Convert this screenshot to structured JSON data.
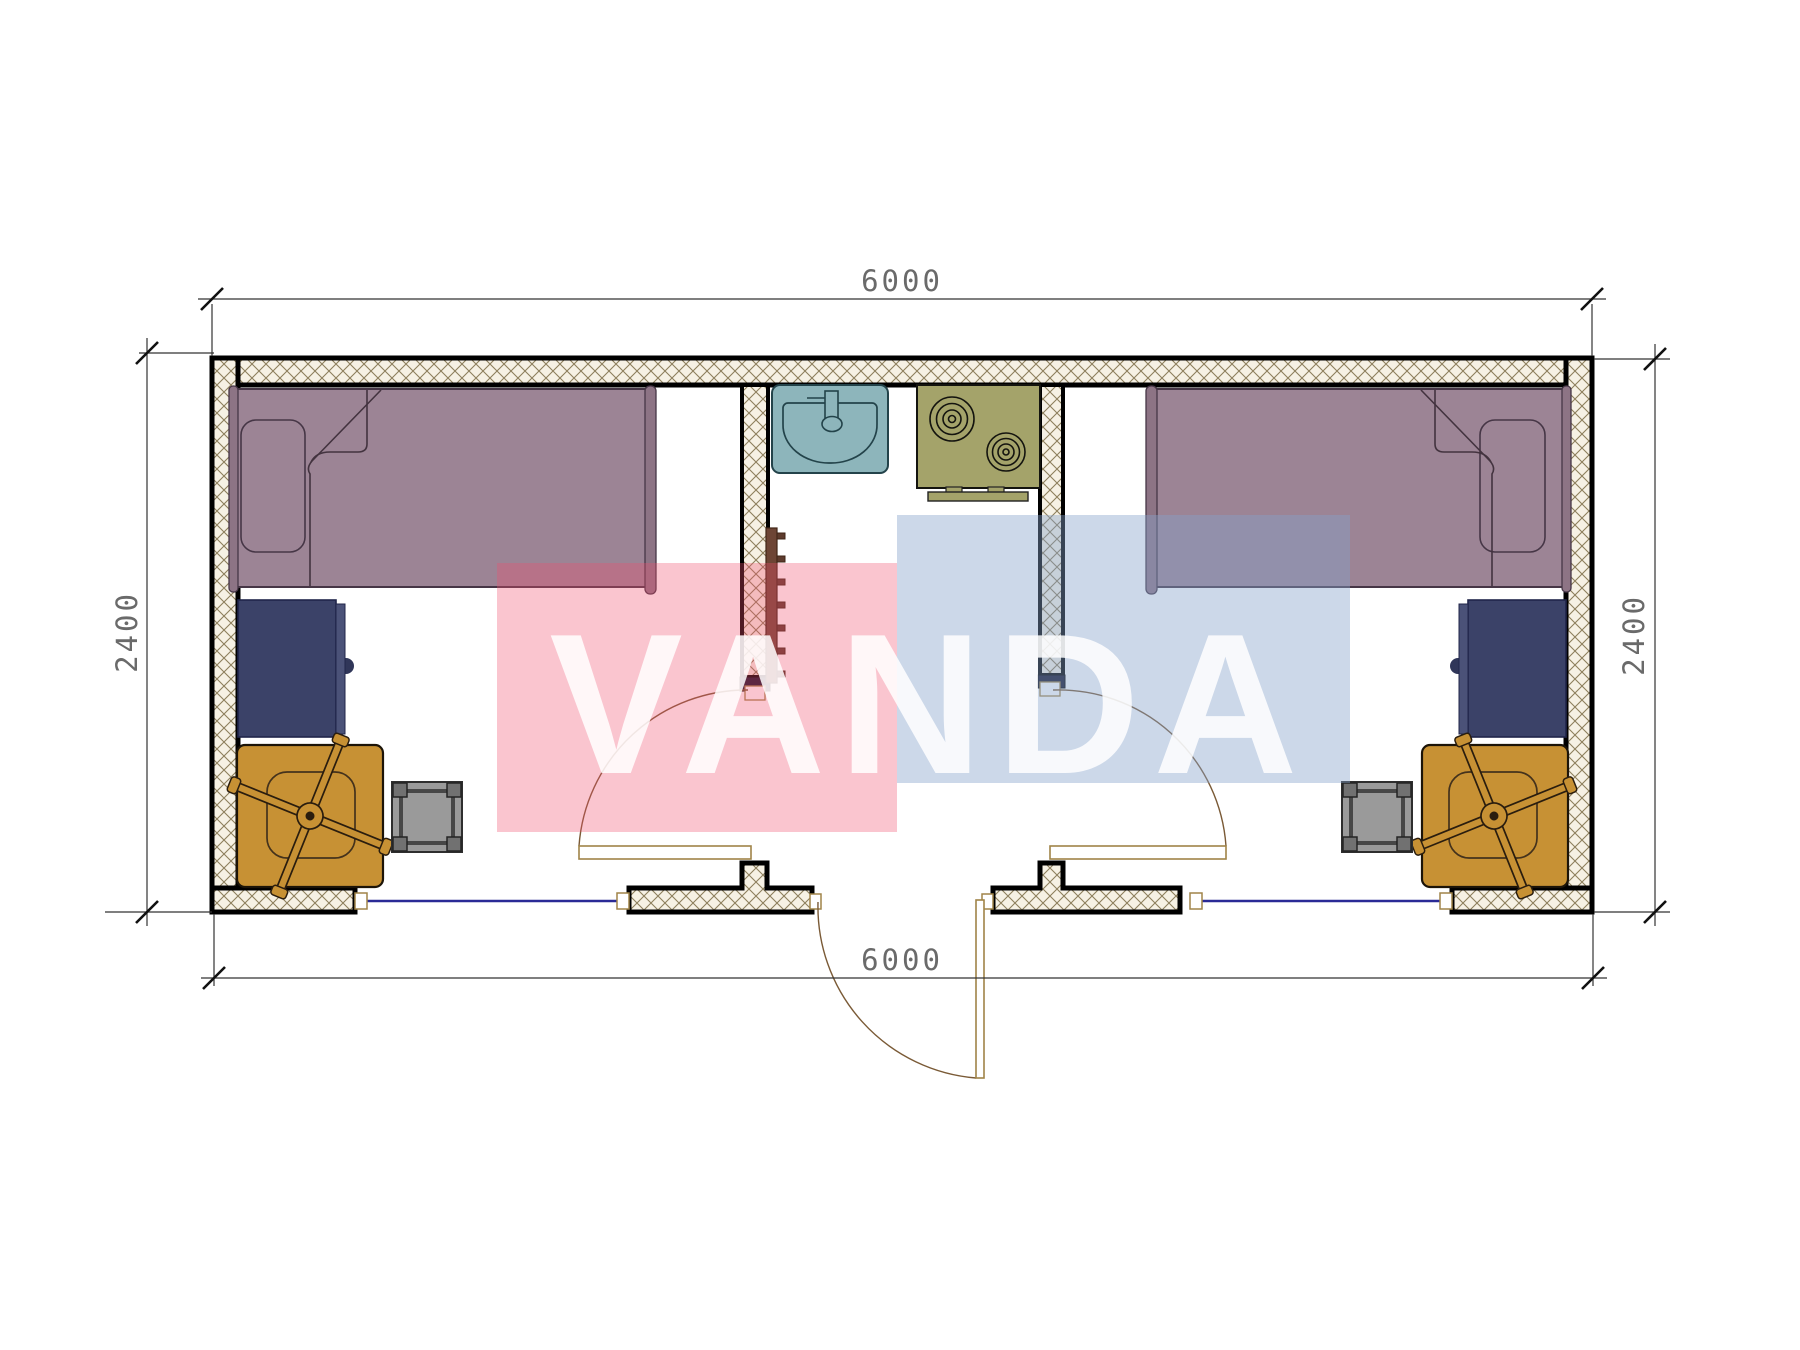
{
  "watermark": {
    "text": "VANDA",
    "pink_color": "#f04f6e",
    "blue_color": "#86a1ca",
    "text_color": "#ffffff"
  },
  "dimensions": {
    "top_width": "6000",
    "bottom_width": "6000",
    "left_height": "2400",
    "right_height": "2400"
  },
  "colors": {
    "bed": "#9c8495",
    "bed_outline": "#463646",
    "desk": "#3b4268",
    "desk_strip": "#4b5278",
    "chair": "#c79134",
    "chair_outline": "#1c1408",
    "stool": "#9a9a9a",
    "stool_post": "#717171",
    "sink": "#8db5bb",
    "stove": "#a4a36a",
    "wall_fill": "#f6f1e4",
    "wall_hatch_line": "#8d7f5c",
    "window_line": "#2a2a96",
    "door_leaf_outline": "#a08448",
    "door_arc": "#7a5a36",
    "towel_rail": "#6d4535"
  },
  "plan": {
    "type": "floor-plan",
    "overall_size_mm": {
      "width": 6000,
      "depth": 2400
    },
    "rooms": [
      {
        "name": "left-bedroom",
        "furniture": [
          "single-bed",
          "desk",
          "office-chair",
          "stool"
        ]
      },
      {
        "name": "center-kitchen-bath",
        "furniture": [
          "sink",
          "two-burner-stove",
          "towel-rail"
        ]
      },
      {
        "name": "right-bedroom",
        "furniture": [
          "single-bed",
          "desk",
          "office-chair",
          "stool"
        ]
      }
    ],
    "openings": [
      "left-window",
      "left-room-door",
      "entrance-door",
      "right-room-door",
      "right-window"
    ]
  }
}
